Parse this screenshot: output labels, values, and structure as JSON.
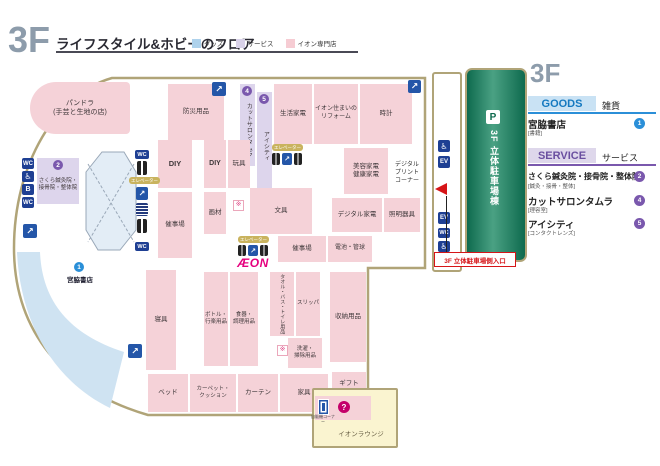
{
  "header": {
    "floor": "3F",
    "title": "ライフスタイル&ホビーのフロア",
    "legend": [
      {
        "label": "グッズ",
        "color": "#aed2ec"
      },
      {
        "label": "サービス",
        "color": "#d9d2e9"
      },
      {
        "label": "イオン専門店",
        "color": "#f6ccd3"
      }
    ]
  },
  "sidebar": {
    "floor": "3F",
    "goods_heading": "GOODS",
    "goods_heading_ja": "雑貨",
    "goods_items": [
      {
        "name": "宮脇書店",
        "category": "[書籍]",
        "badge": "1"
      }
    ],
    "service_heading": "SERVICE",
    "service_heading_ja": "サービス",
    "service_items": [
      {
        "name": "さくら鍼灸院・接骨院・整体院",
        "category": "[鍼灸・接骨・整体]",
        "badge": "2"
      },
      {
        "name": "カットサロンタムラ",
        "category": "[理容室]",
        "badge": "4"
      },
      {
        "name": "アイシティ",
        "category": "[コンタクトレンズ]",
        "badge": "5"
      }
    ]
  },
  "parking": {
    "p_icon": "P",
    "building_label": "3F 立体駐車場棟",
    "entrance_label": "3F 立体駐車場側入口"
  },
  "map": {
    "aeon_logo": "ÆON",
    "elevator_chip": "エレベーター",
    "lounge_label": "イオンラウンジ",
    "vending_caption": "自販機コーナー",
    "note_mark": "※",
    "badges": {
      "miyawaki": "1",
      "sakura": "2",
      "tamura": "4",
      "eyecity": "5"
    },
    "colors": {
      "outline": "#b0a478",
      "goods_area": "#cfe3f2",
      "service_area": "#ddd5ec",
      "tenant_area": "#f5d2d8",
      "parking_green": "#1d7a58",
      "accent_red": "#d61518",
      "aeon_magenta": "#e5007e"
    },
    "blocks": {
      "pandora": "パンドラ\n(手芸と生地の店)",
      "bousai": "防災用品",
      "tamura": "カットサロンタムラ",
      "eyecity": "アイシティ",
      "seikatsu_kaden": "生活家電",
      "reform": "イオン住まいの\nリフォーム",
      "tokei": "時計",
      "biyou_kaden": "美容家電\n健康家電",
      "digital_print": "デジタル\nプリント\nコーナー",
      "sakura": "さくら鍼灸院・\n接骨院・整体院",
      "diy1": "DIY",
      "saijijo1": "催事場",
      "diy2": "DIY",
      "gangu": "玩具",
      "gazai": "画材",
      "bungu": "文具",
      "digital_kaden": "デジタル家電",
      "shoumei": "照明器具",
      "saijijo2": "催事場",
      "denchi": "電池・管球",
      "miyawaki": "宮脇書店",
      "shingu": "寝具",
      "bottle": "ボトル・\n行楽用品",
      "shokki": "食器・\n調理用品",
      "towel": "タオル・バス・トイレ用品",
      "slipper": "スリッパ",
      "sentaku": "洗濯・\n掃除用品",
      "shunou": "収納用品",
      "gift": "ギフト",
      "bed": "ベッド",
      "carpet": "カーペット・\nクッション",
      "curtain": "カーテン",
      "kagu": "家具"
    },
    "icons": {
      "wc": "WC",
      "wheelchair": "♿",
      "nursing": "B",
      "elevator": "EV",
      "escalator": "↗",
      "info": "?"
    }
  }
}
